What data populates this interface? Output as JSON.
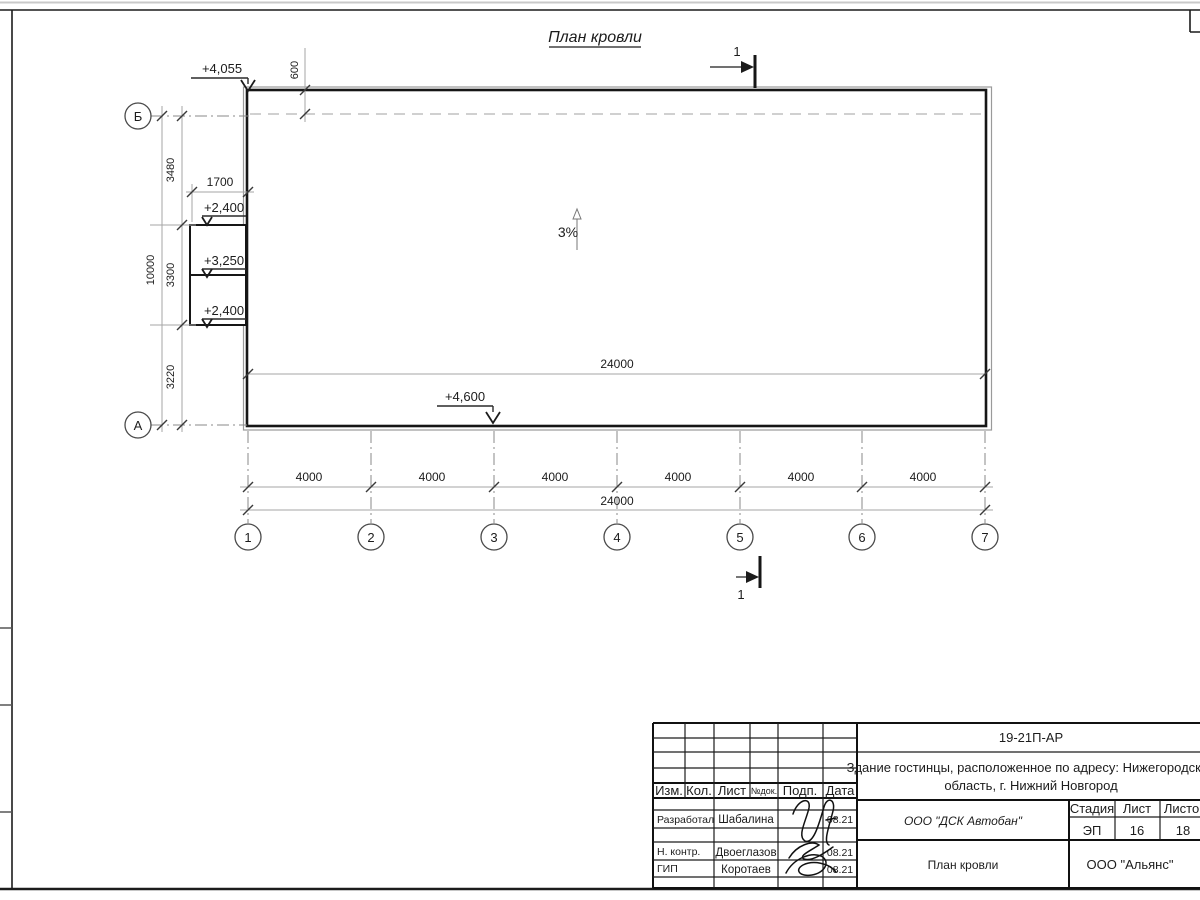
{
  "drawing": {
    "title": "План кровли",
    "slope_label": "3%",
    "section_label": "1",
    "elevations": {
      "roof_high": "+4,055",
      "roof_low": "+4,600",
      "canopy_top": "+2,400",
      "canopy_mid": "+3,250",
      "canopy_bot": "+2,400"
    },
    "dims": {
      "overhang": "600",
      "canopy_width": "1700",
      "left_chain": [
        "3480",
        "3300",
        "3220"
      ],
      "left_total": "10000",
      "span_inner_total": "24000",
      "bottom_chain": [
        "4000",
        "4000",
        "4000",
        "4000",
        "4000",
        "4000"
      ],
      "bottom_total": "24000"
    },
    "axes": {
      "rows": [
        "Б",
        "А"
      ],
      "cols": [
        "1",
        "2",
        "3",
        "4",
        "5",
        "6",
        "7"
      ]
    }
  },
  "title_block": {
    "doc_code": "19-21П-АР",
    "project_name_line1": "Здание гостинцы, расположенное по адресу: Нижегородская",
    "project_name_line2": "область, г. Нижний Новгород",
    "contractor": "ООО \"ДСК Автобан\"",
    "sheet_title": "План кровли",
    "client": "ООО \"Альянс\"",
    "stage_header": "Стадия",
    "sheet_header": "Лист",
    "sheets_header": "Листов",
    "stage_value": "ЭП",
    "sheet_value": "16",
    "sheets_value": "18",
    "cols": [
      "Изм.",
      "Кол.",
      "Лист",
      "№док.",
      "Подп.",
      "Дата"
    ],
    "roles": [
      {
        "role": "Разработал",
        "name": "Шабалина",
        "date": "08.21"
      },
      {
        "role": "Н. контр.",
        "name": "Двоеглазов",
        "date": "08.21"
      },
      {
        "role": "ГИП",
        "name": "Коротаев",
        "date": "08.21"
      }
    ]
  }
}
